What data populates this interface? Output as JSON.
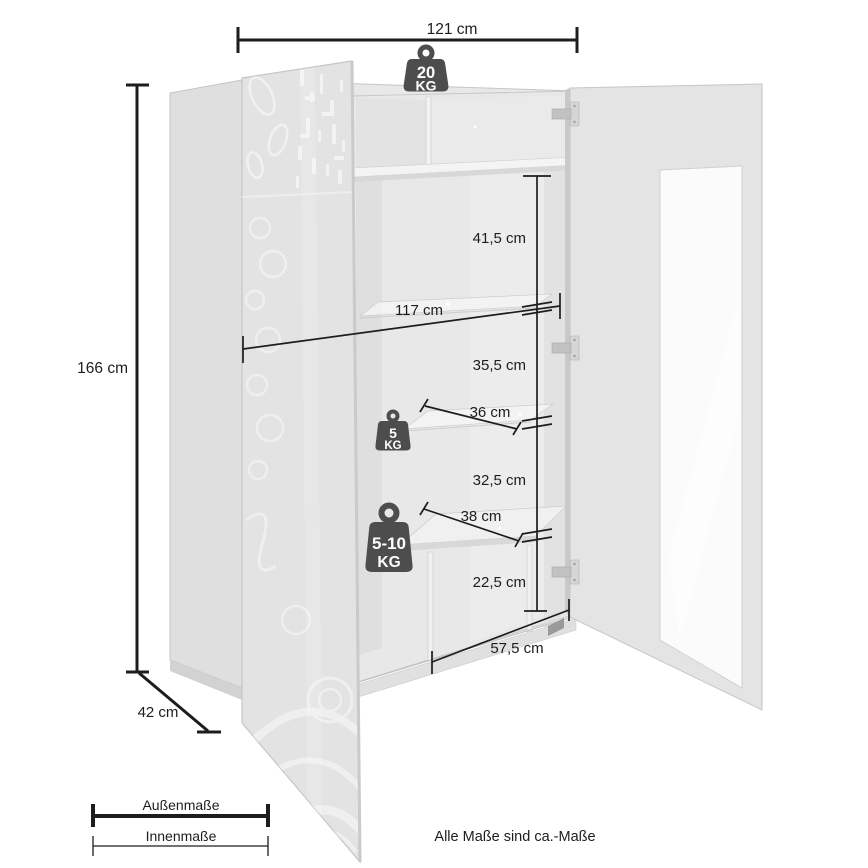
{
  "product_diagram": {
    "footnote": "Alle Maße sind ca.-Maße",
    "legend": {
      "outer": "Außenmaße",
      "inner": "Innenmaße"
    },
    "dimensions": {
      "outer_width": "121 cm",
      "outer_height": "166 cm",
      "outer_depth": "42 cm",
      "top_section_height": "41,5 cm",
      "inner_width": "117 cm",
      "mid_section_height": "35,5 cm",
      "glass_shelf_depth": "36 cm",
      "lower_section_height": "32,5 cm",
      "wood_shelf_depth": "38 cm",
      "bottom_section_height": "22,5 cm",
      "bottom_inner_width": "57,5 cm"
    },
    "load_capacities": {
      "top": {
        "value": "20",
        "unit": "KG"
      },
      "glass_shelf": {
        "value": "5",
        "unit": "KG"
      },
      "wood_shelf": {
        "value": "5-10",
        "unit": "KG"
      }
    },
    "colors": {
      "dimension_line": "#1d1d1b",
      "weight_icon": "#4d4d4d",
      "cabinet_body": "#e8e8e8",
      "cabinet_shadow": "#d6d6d6",
      "glass": "#fbfbfb"
    }
  }
}
